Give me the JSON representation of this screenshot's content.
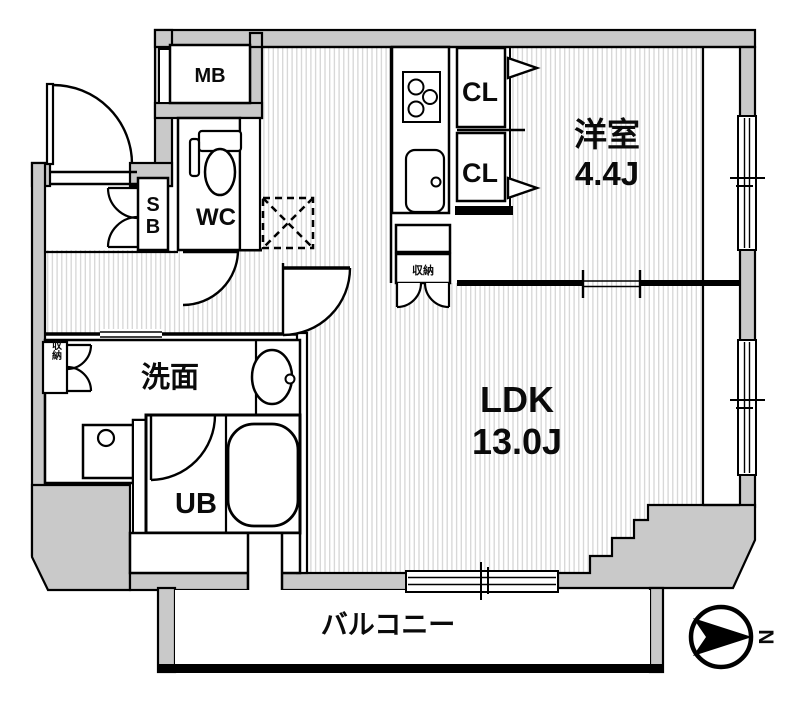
{
  "colors": {
    "wall_fill": "#c9c9c9",
    "hatch_line": "#d6d6d6",
    "outline": "#000000",
    "background": "#ffffff"
  },
  "rooms": {
    "western": {
      "name": "洋室",
      "size": "4.4J"
    },
    "ldk": {
      "name": "LDK",
      "size": "13.0J"
    },
    "washroom": {
      "name": "洗面"
    },
    "unit_bath": {
      "name": "UB"
    },
    "toilet": {
      "name": "WC"
    },
    "balcony": {
      "name": "バルコニー"
    }
  },
  "storage": {
    "closet_upper": "CL",
    "closet_lower": "CL",
    "kitchen_storage": "収納",
    "washroom_storage": "収納",
    "shoe_box_letters": [
      "S",
      "B"
    ]
  },
  "facilities": {
    "meter_box": "MB"
  },
  "compass": {
    "north": "N"
  }
}
